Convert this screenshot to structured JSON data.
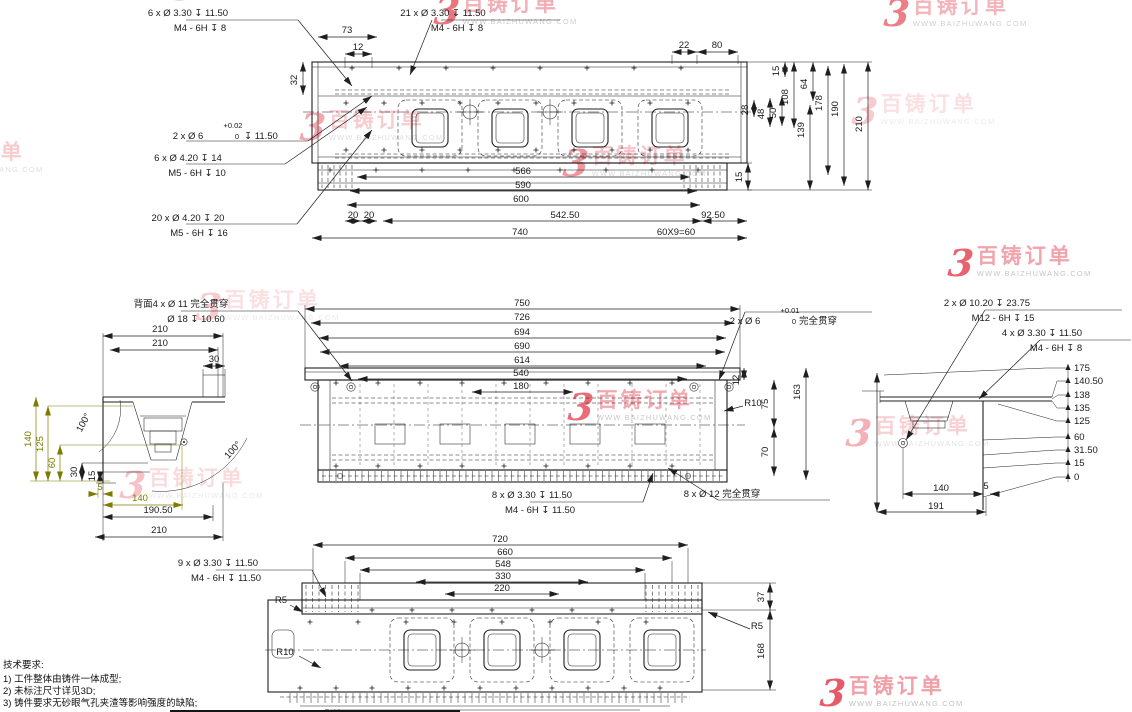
{
  "colors": {
    "line": "#1f1f1f",
    "dim_highlight_olive": "#7c7c00",
    "watermark_red": "#e65360",
    "watermark_pink": "#f09ba3",
    "watermark_gray": "#bfbfbf",
    "background": "#ffffff"
  },
  "watermark": {
    "brand": "百铸订单",
    "url": "WWW.BAIZHUWANG.COM"
  },
  "notes": {
    "title": "技术要求:",
    "items": [
      "1) 工件整体由铸件一体成型;",
      "2) 未标注尺寸详见3D;",
      "3) 铸件要求无砂眼气孔夹渣等影响强度的缺陷;"
    ]
  },
  "views": {
    "top_view": {
      "callout_lines": [
        {
          "t": "6 x Ø 3.30 ↧ 11.50",
          "x": 188,
          "y": 16
        },
        {
          "t": "M4 - 6H ↧ 8",
          "x": 200,
          "y": 31
        },
        {
          "t": "21 x Ø 3.30 ↧ 11.50",
          "x": 443,
          "y": 16
        },
        {
          "t": "M4 - 6H ↧ 8",
          "x": 457,
          "y": 31
        },
        {
          "t": "2 x Ø 6",
          "x": 188,
          "y": 139
        },
        {
          "t": "+0.02",
          "x": 233,
          "y": 128,
          "fs": 7.5
        },
        {
          "t": "0",
          "x": 237,
          "y": 139,
          "fs": 7.5
        },
        {
          "t": "↧ 11.50",
          "x": 261,
          "y": 139
        },
        {
          "t": "6 x Ø 4.20 ↧ 14",
          "x": 188,
          "y": 161
        },
        {
          "t": "M5 - 6H ↧ 10",
          "x": 197,
          "y": 176
        },
        {
          "t": "20 x Ø 4.20 ↧ 20",
          "x": 188,
          "y": 221
        },
        {
          "t": "M5 - 6H ↧ 16",
          "x": 199,
          "y": 236
        }
      ],
      "dim_labels": [
        {
          "t": "73",
          "x": 347,
          "y": 33
        },
        {
          "t": "12",
          "x": 358,
          "y": 50
        },
        {
          "t": "32",
          "x": 297,
          "y": 80,
          "r": -90
        },
        {
          "t": "22",
          "x": 684,
          "y": 48
        },
        {
          "t": "80",
          "x": 717,
          "y": 48
        },
        {
          "t": "15",
          "x": 779,
          "y": 71,
          "r": -90
        },
        {
          "t": "64",
          "x": 807,
          "y": 84,
          "r": -90
        },
        {
          "t": "108",
          "x": 788,
          "y": 97,
          "r": -90
        },
        {
          "t": "28",
          "x": 748,
          "y": 110,
          "r": -90
        },
        {
          "t": "48",
          "x": 764,
          "y": 114,
          "r": -90
        },
        {
          "t": "50",
          "x": 776,
          "y": 113,
          "r": -90
        },
        {
          "t": "139",
          "x": 804,
          "y": 130,
          "r": -90
        },
        {
          "t": "178",
          "x": 822,
          "y": 103,
          "r": -90
        },
        {
          "t": "190",
          "x": 838,
          "y": 109,
          "r": -90
        },
        {
          "t": "210",
          "x": 862,
          "y": 124,
          "r": -90
        },
        {
          "t": "15",
          "x": 742,
          "y": 177,
          "r": -90
        },
        {
          "t": "566",
          "x": 523,
          "y": 174
        },
        {
          "t": "590",
          "x": 523,
          "y": 188
        },
        {
          "t": "600",
          "x": 521,
          "y": 202
        },
        {
          "t": "20",
          "x": 353,
          "y": 218
        },
        {
          "t": "20",
          "x": 369,
          "y": 218
        },
        {
          "t": "542.50",
          "x": 565,
          "y": 218
        },
        {
          "t": "92.50",
          "x": 713,
          "y": 218
        },
        {
          "t": "740",
          "x": 520,
          "y": 235
        },
        {
          "t": "60X9=60",
          "x": 676,
          "y": 235
        }
      ]
    },
    "front_view": {
      "callout_lines": [
        {
          "t": "背面4 x Ø 11 完全贯穿",
          "x": 181,
          "y": 307
        },
        {
          "t": "Ø 18 ↧ 10.60",
          "x": 196,
          "y": 322
        },
        {
          "t": "2 x Ø 6",
          "x": 745,
          "y": 324
        },
        {
          "t": "+0.01",
          "x": 790,
          "y": 313,
          "fs": 7.5
        },
        {
          "t": "0",
          "x": 794,
          "y": 324,
          "fs": 7.5
        },
        {
          "t": "完全贯穿",
          "x": 818,
          "y": 324
        },
        {
          "t": "2 x Ø 10.20 ↧ 23.75",
          "x": 987,
          "y": 306
        },
        {
          "t": "M12 - 6H ↧ 15",
          "x": 1003,
          "y": 321
        },
        {
          "t": "4 x Ø 3.30 ↧ 11.50",
          "x": 1042,
          "y": 336
        },
        {
          "t": "M4 - 6H ↧ 8",
          "x": 1056,
          "y": 351
        },
        {
          "t": "8 x Ø 3.30 ↧ 11.50",
          "x": 532,
          "y": 498
        },
        {
          "t": "M4 - 6H ↧ 11.50",
          "x": 540,
          "y": 513
        },
        {
          "t": "8 x Ø 12 完全贯穿",
          "x": 722,
          "y": 497
        }
      ],
      "dim_labels": [
        {
          "t": "750",
          "x": 522,
          "y": 306
        },
        {
          "t": "726",
          "x": 522,
          "y": 320
        },
        {
          "t": "694",
          "x": 522,
          "y": 335
        },
        {
          "t": "690",
          "x": 522,
          "y": 349
        },
        {
          "t": "614",
          "x": 522,
          "y": 363
        },
        {
          "t": "540",
          "x": 521,
          "y": 376
        },
        {
          "t": "180",
          "x": 521,
          "y": 389
        },
        {
          "t": "12",
          "x": 739,
          "y": 380,
          "r": -90
        },
        {
          "t": "75",
          "x": 768,
          "y": 404,
          "r": -90
        },
        {
          "t": "70",
          "x": 768,
          "y": 452,
          "r": -90
        },
        {
          "t": "163",
          "x": 800,
          "y": 392,
          "r": -90
        },
        {
          "t": "R10",
          "x": 753,
          "y": 406
        }
      ]
    },
    "right_section": {
      "ordinate_labels": [
        {
          "t": "175",
          "x": 1074,
          "y": 371,
          "a": "s"
        },
        {
          "t": "140.50",
          "x": 1074,
          "y": 384,
          "a": "s"
        },
        {
          "t": "138",
          "x": 1074,
          "y": 398,
          "a": "s"
        },
        {
          "t": "135",
          "x": 1074,
          "y": 411,
          "a": "s"
        },
        {
          "t": "125",
          "x": 1074,
          "y": 424,
          "a": "s"
        },
        {
          "t": "60",
          "x": 1074,
          "y": 440,
          "a": "s"
        },
        {
          "t": "31.50",
          "x": 1074,
          "y": 453,
          "a": "s"
        },
        {
          "t": "15",
          "x": 1074,
          "y": 466,
          "a": "s"
        },
        {
          "t": "0",
          "x": 1074,
          "y": 480,
          "a": "s"
        }
      ],
      "dim_labels": [
        {
          "t": "140",
          "x": 941,
          "y": 491
        },
        {
          "t": "5",
          "x": 986,
          "y": 489
        },
        {
          "t": "191",
          "x": 936,
          "y": 509
        }
      ]
    },
    "left_section": {
      "dim_labels": [
        {
          "t": "210",
          "x": 160,
          "y": 332
        },
        {
          "t": "210",
          "x": 160,
          "y": 346
        },
        {
          "t": "30",
          "x": 214,
          "y": 362
        },
        {
          "t": "100°",
          "x": 86,
          "y": 424,
          "r": -62
        },
        {
          "t": "100°",
          "x": 235,
          "y": 452,
          "r": -48
        },
        {
          "t": "140",
          "x": 31,
          "y": 439,
          "r": -90,
          "c": "olive"
        },
        {
          "t": "125",
          "x": 43,
          "y": 444,
          "r": -90,
          "c": "olive"
        },
        {
          "t": "60",
          "x": 55,
          "y": 463,
          "r": -90,
          "c": "olive"
        },
        {
          "t": "30",
          "x": 77,
          "y": 472,
          "r": -90
        },
        {
          "t": "15",
          "x": 95,
          "y": 476,
          "r": -90
        },
        {
          "t": "5",
          "x": 100,
          "y": 490,
          "c": "olive"
        },
        {
          "t": "140",
          "x": 140,
          "y": 501,
          "c": "olive"
        },
        {
          "t": "190.50",
          "x": 158,
          "y": 513
        },
        {
          "t": "210",
          "x": 159,
          "y": 533
        }
      ]
    },
    "bottom_view": {
      "callout_lines": [
        {
          "t": "9 x Ø 3.30 ↧ 11.50",
          "x": 218,
          "y": 566
        },
        {
          "t": "M4 - 6H ↧ 11.50",
          "x": 226,
          "y": 581
        }
      ],
      "dim_labels": [
        {
          "t": "720",
          "x": 500,
          "y": 542
        },
        {
          "t": "660",
          "x": 505,
          "y": 555
        },
        {
          "t": "548",
          "x": 503,
          "y": 567
        },
        {
          "t": "330",
          "x": 503,
          "y": 579
        },
        {
          "t": "220",
          "x": 502,
          "y": 591
        },
        {
          "t": "R5",
          "x": 281,
          "y": 603
        },
        {
          "t": "R10",
          "x": 285,
          "y": 655
        },
        {
          "t": "37",
          "x": 764,
          "y": 597,
          "r": -90
        },
        {
          "t": "R5",
          "x": 757,
          "y": 629
        },
        {
          "t": "168",
          "x": 764,
          "y": 651,
          "r": -90
        },
        {
          "t": "R40",
          "x": 333,
          "y": 716
        }
      ]
    }
  }
}
